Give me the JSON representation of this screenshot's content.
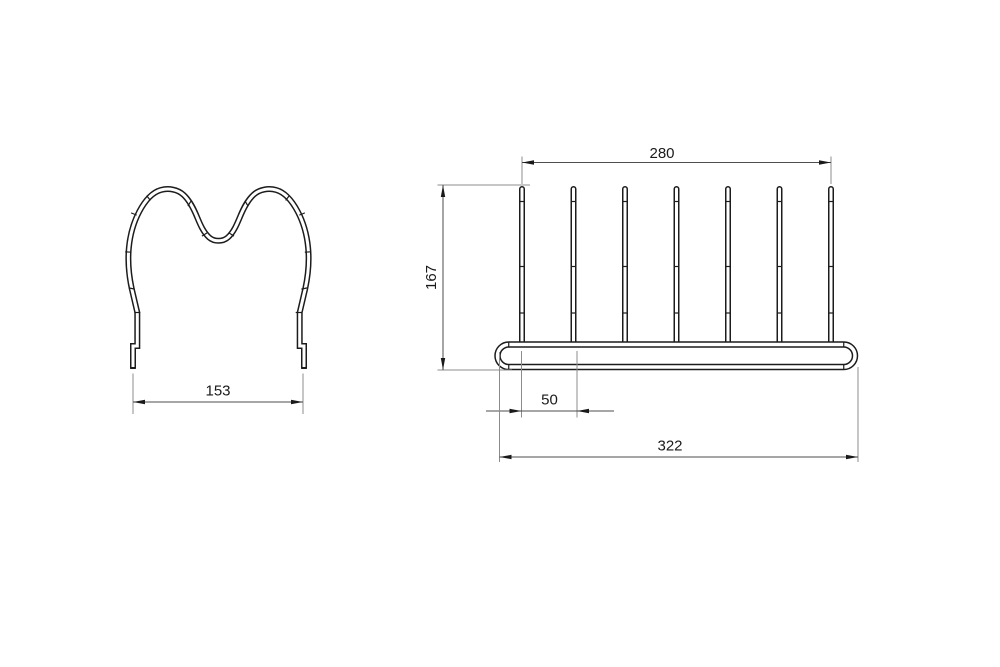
{
  "drawing": {
    "dimensions": {
      "side_width": "153",
      "prong_span": "280",
      "height": "167",
      "prong_pitch": "50",
      "base_width": "322"
    },
    "colors": {
      "background": "#ffffff",
      "geometry": "#1c1c1c",
      "dimension_line": "#4d4d4d",
      "extension_line": "#8c8c8c",
      "text": "#1a1a1a"
    }
  }
}
